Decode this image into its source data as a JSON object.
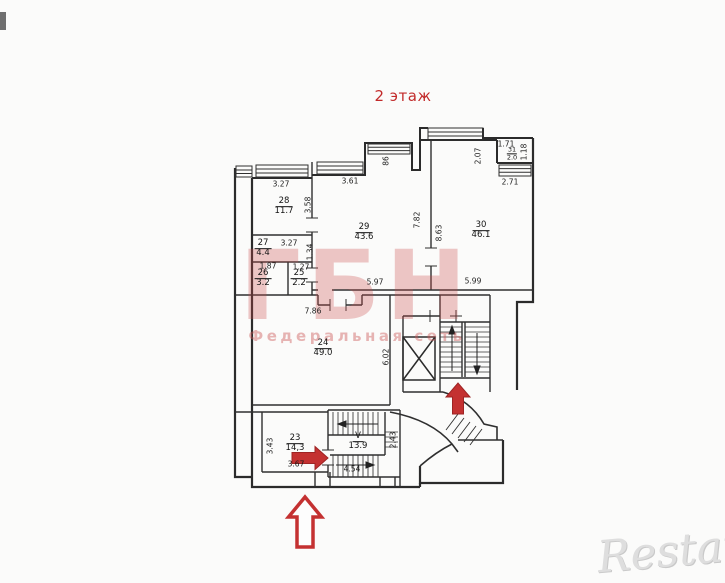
{
  "plan": {
    "title": "2 этаж",
    "title_color": "#c22a2a"
  },
  "watermarks": {
    "brand_big": "ГБН",
    "brand_sub": "Федеральная сеть",
    "restate": "Restate",
    "pink": "#d98a8a",
    "gray": "#dedede"
  },
  "colors": {
    "wall_line": "#2b2b2b",
    "arrow_red": "#c43131"
  },
  "icons": {
    "entrance_arrow_right": "red-arrow-right",
    "entrance_arrow_up_stairs": "red-arrow-up",
    "entrance_arrow_up_outline": "red-arrow-up-outline"
  },
  "rooms": {
    "r28": {
      "num": "28",
      "area": "11.7"
    },
    "r27": {
      "num": "27",
      "area": "4.4"
    },
    "r26": {
      "num": "26",
      "area": "3.2"
    },
    "r25": {
      "num": "25",
      "area": "2.2"
    },
    "r29": {
      "num": "29",
      "area": "43.6"
    },
    "r30": {
      "num": "30",
      "area": "46.1"
    },
    "r31": {
      "num": "31",
      "area": "2.0"
    },
    "r24": {
      "num": "24",
      "area": "49.0"
    },
    "r23": {
      "num": "23",
      "area": "14,3"
    },
    "stair": {
      "num": "V",
      "area": "13.9"
    }
  },
  "dims": {
    "room28_top": "3.27",
    "room28_right": "3.58",
    "room29_top": "3.61",
    "room29_notch": "86",
    "room29_right": "7.82",
    "room29_bottom": "5.97",
    "room30_left": "8.63",
    "room30_top": "2.71",
    "room30_bottom": "5.99",
    "room31_width": "1.71",
    "room31_height": "1.18",
    "room31_left": "2.07",
    "room27_top": "3.27",
    "room27_right": "1.34",
    "room26_top": "1.87",
    "room25_top": "1.27",
    "room24_top": "7.86",
    "room24_right": "6.02",
    "room23_left": "3.43",
    "room23_bottom": "3.67",
    "stair_bottom": "4.54",
    "stair_right": "2.43"
  }
}
